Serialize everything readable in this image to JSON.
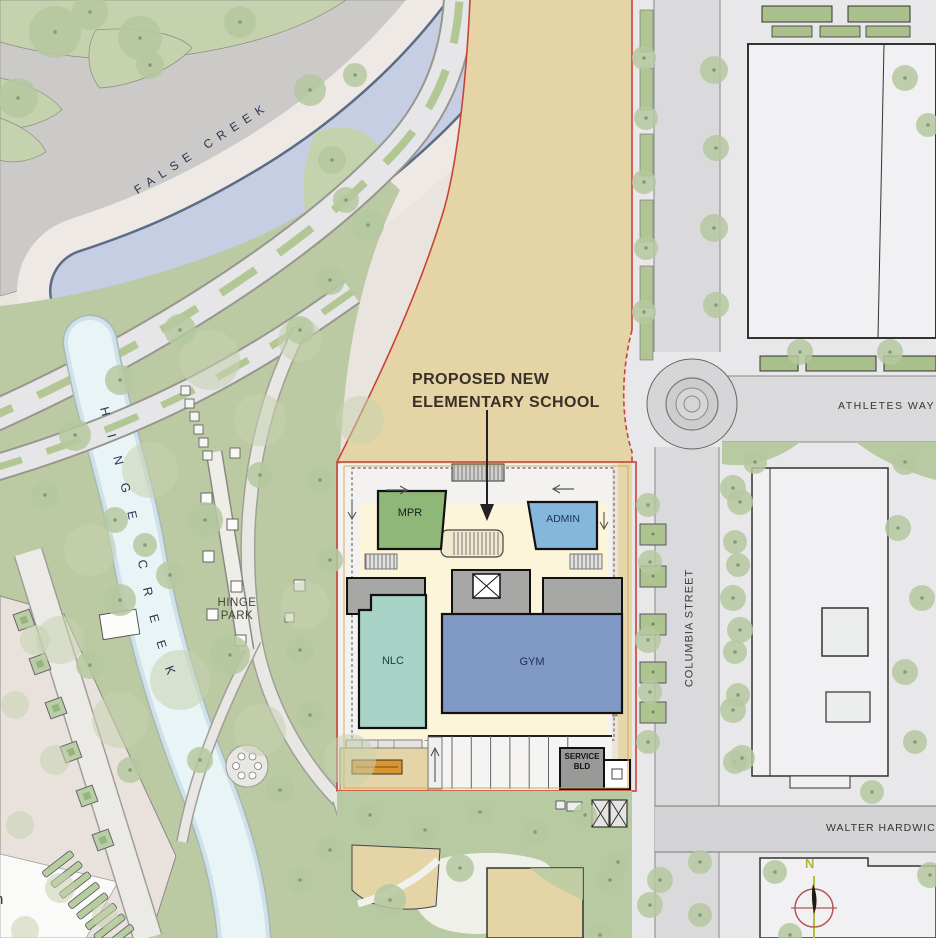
{
  "labels": {
    "false_creek": "FALSE CREEK",
    "hinge_creek": "HINGE CREEK",
    "hinge_park_line1": "HINGE",
    "hinge_park_line2": "PARK",
    "proposed_line1": "PROPOSED NEW",
    "proposed_line2": "ELEMENTARY SCHOOL",
    "athletes_way": "ATHLETES WAY",
    "columbia_street": "COLUMBIA STREET",
    "walter_hardwick": "WALTER HARDWICK",
    "edge_partial": "n"
  },
  "buildings": {
    "mpr": "MPR",
    "admin": "ADMIN",
    "nlc": "NLC",
    "gym": "GYM",
    "service_line1": "SERVICE",
    "service_line2": "BLD"
  },
  "compass": {
    "north": "N"
  },
  "colors": {
    "site_tan": "#e5d4a5",
    "boundary_red": "#c8443a",
    "envelope_amber": "#d9a14a",
    "mpr_green": "#8fb878",
    "admin_blue": "#85b7dc",
    "nlc_teal": "#a7d4c6",
    "gym_blue": "#8099c4",
    "water_blue": "#c6cee4",
    "creek_blue": "#e9f4f7",
    "park_green": "#bccaa3"
  }
}
